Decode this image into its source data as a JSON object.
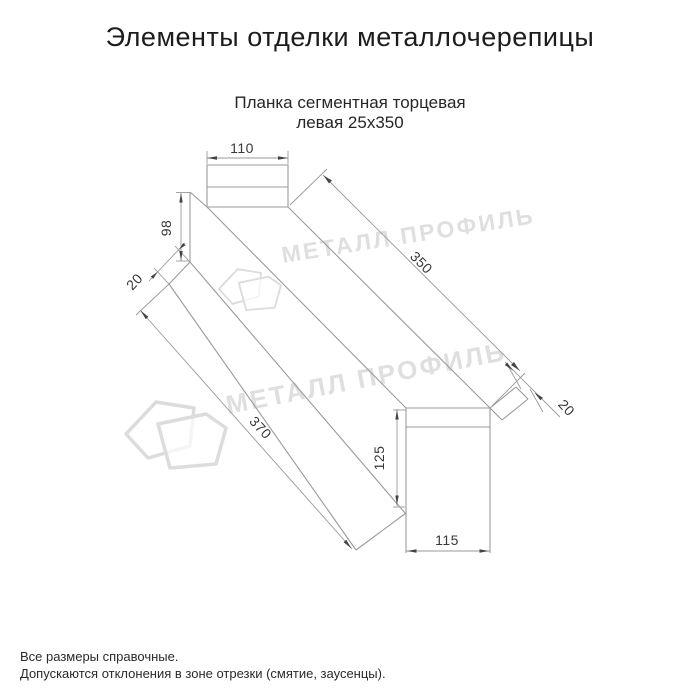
{
  "page": {
    "title": "Элементы отделки металлочерепицы"
  },
  "product": {
    "subtitle_line1": "Планка сегментная торцевая",
    "subtitle_line2": "левая 25x350"
  },
  "diagram": {
    "type": "technical-drawing",
    "dimensions": {
      "top_flange_width": "110",
      "left_end_height": "98",
      "top_hem": "20",
      "top_edge_length": "350",
      "bottom_edge_length": "370",
      "end_hem": "20",
      "right_end_height": "125",
      "bottom_end_width": "115"
    }
  },
  "watermark": {
    "text": "МЕТАЛЛ ПРОФИЛЬ",
    "logo": "metall-profil-logo"
  },
  "footer": {
    "line1": "Все размеры справочные.",
    "line2": "Допускаются отклонения в зоне отрезки (смятие, заусенцы)."
  },
  "colors": {
    "drawing_line": "#9a9a9a",
    "arrow": "#444444",
    "dimension_text": "#383838",
    "title_text": "#1c1c1c",
    "watermark": "#dcdcdc"
  }
}
